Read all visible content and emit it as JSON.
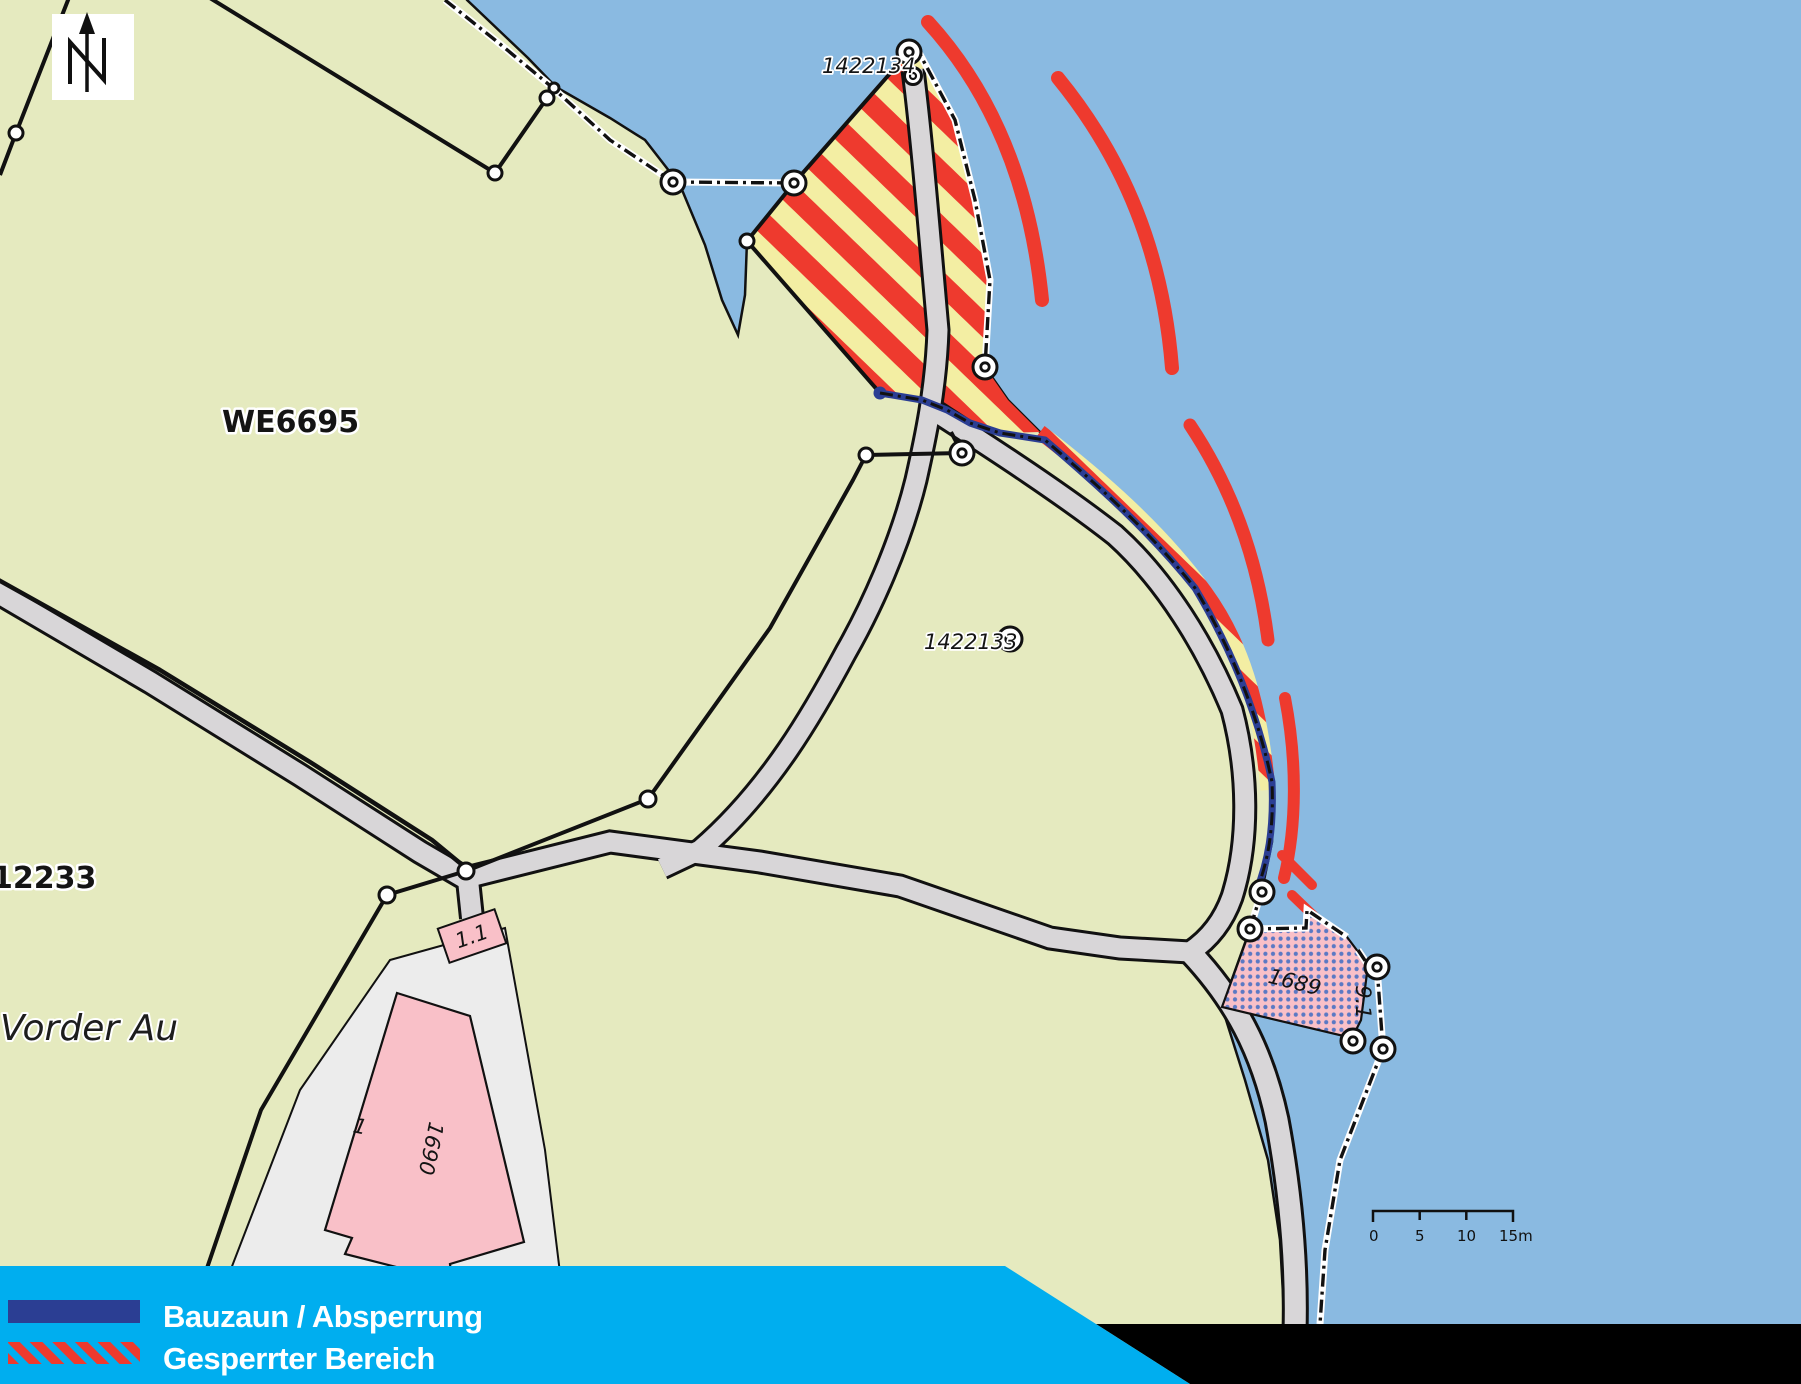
{
  "labels": {
    "we6695": "WE6695",
    "p12233": "12233",
    "vorder_au": "Vorder Au",
    "pt_1422134": "1422134",
    "pt_1422133": "1422133",
    "bldg_1689": "1689",
    "bldg_1689_dim": "9.1",
    "bldg_1690": "1690",
    "bldg_1690_no": "1",
    "bldg_1_1": "1.1"
  },
  "scale_bar": {
    "ticks": [
      "0",
      "5",
      "10",
      "15m"
    ]
  },
  "legend": {
    "items": [
      {
        "swatch": "fence-line",
        "label": "Bauzaun / Absperrung"
      },
      {
        "swatch": "red-hatch",
        "label": "Gesperrter Bereich"
      }
    ]
  },
  "colors": {
    "water": "#8ABAE1",
    "land": "#E5EABF",
    "closed_area_red": "#EE3A2E",
    "closed_area_yellow": "#F3EEA3",
    "fence_blue": "#2B3E93",
    "legend_cyan": "#00AEEF",
    "building_pink": "#F9C0C8",
    "road_gray": "#D8D6D8"
  }
}
